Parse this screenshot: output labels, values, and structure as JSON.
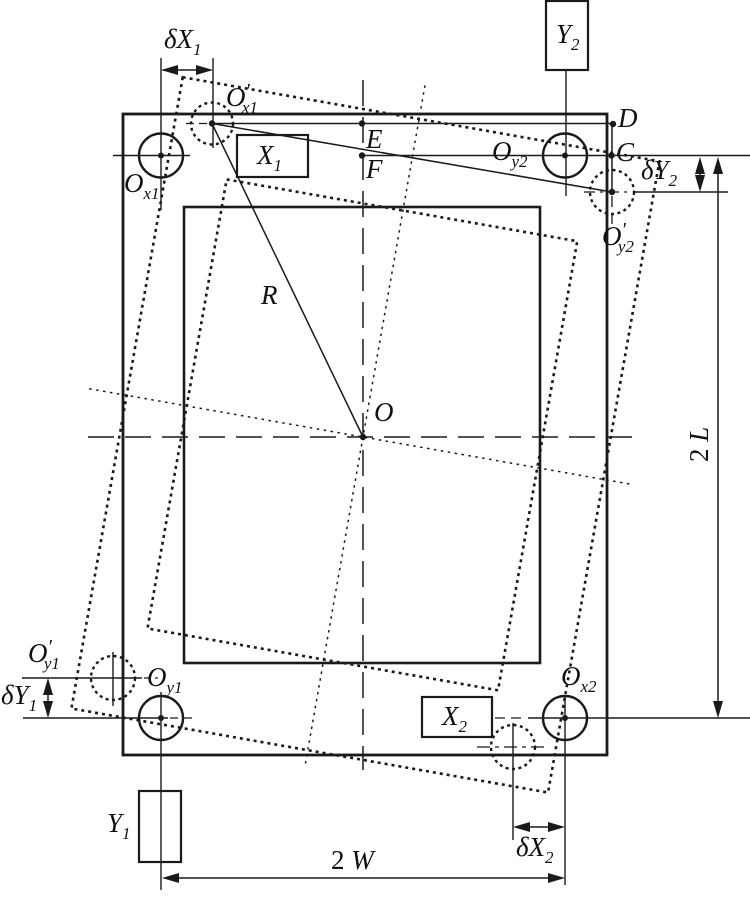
{
  "figure": {
    "colors": {
      "line": "#1a1a1a",
      "background": "#ffffff"
    }
  },
  "labels": {
    "delta_x1": {
      "main": "δX",
      "sub": "1"
    },
    "o_prime_x1": {
      "main": "O",
      "prime": "′",
      "sub": "x1"
    },
    "x1_sensor": {
      "main": "X",
      "sub": "1"
    },
    "e_point": {
      "main": "E"
    },
    "f_point": {
      "main": "F"
    },
    "o_y2": {
      "main": "O",
      "sub": "y2"
    },
    "d_point": {
      "main": "D"
    },
    "c_point": {
      "main": "C"
    },
    "delta_y2": {
      "main": "δY",
      "sub": "2"
    },
    "o_prime_y2": {
      "main": "O",
      "prime": "′",
      "sub": "y2"
    },
    "y2_sensor": {
      "main": "Y",
      "sub": "2"
    },
    "o_x1": {
      "main": "O",
      "sub": "x1"
    },
    "radius": {
      "main": "R"
    },
    "origin": {
      "main": "O"
    },
    "two_l": {
      "num": "2 ",
      "main": "L"
    },
    "o_prime_y1": {
      "main": "O",
      "prime": "′",
      "sub": "y1"
    },
    "delta_y1": {
      "main": "δY",
      "sub": "1"
    },
    "o_y1": {
      "main": "O",
      "sub": "y1"
    },
    "x2_sensor": {
      "main": "X",
      "sub": "2"
    },
    "o_x2": {
      "main": "O",
      "sub": "x2"
    },
    "delta_x2": {
      "main": "δX",
      "sub": "2"
    },
    "y1_sensor": {
      "main": "Y",
      "sub": "1"
    },
    "two_w": {
      "num": "2 ",
      "main": "W"
    }
  }
}
